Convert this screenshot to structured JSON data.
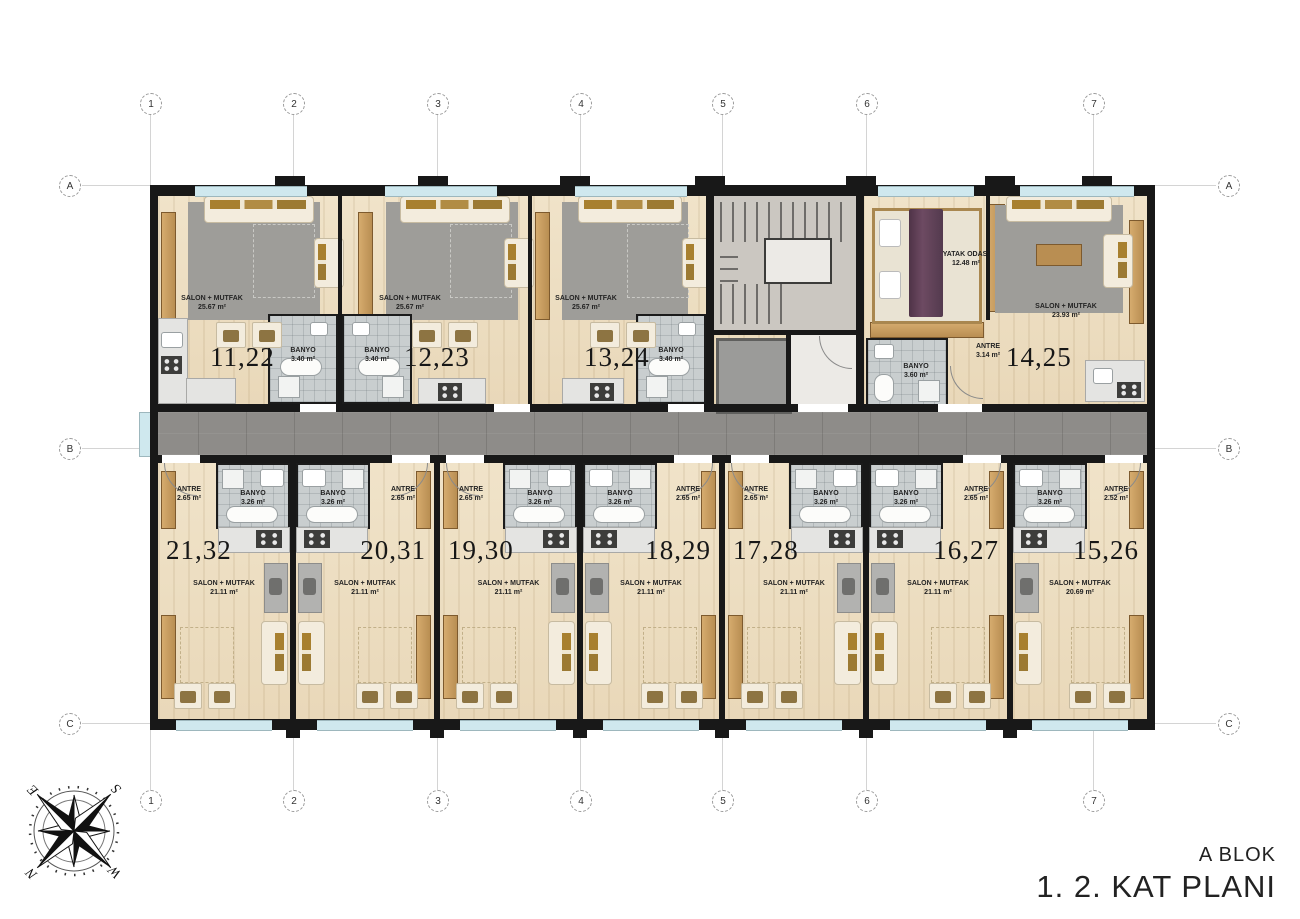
{
  "title": {
    "block": "A BLOK",
    "floor_plan": "1. 2. KAT PLANI"
  },
  "grid": {
    "columns": [
      "1",
      "2",
      "3",
      "4",
      "5",
      "6",
      "7"
    ],
    "rows": [
      "A",
      "B",
      "C"
    ]
  },
  "compass": {
    "north": "N",
    "east": "E",
    "south": "S",
    "west": "W"
  },
  "units": {
    "top": [
      {
        "number": "11,22",
        "salon_label": "SALON + MUTFAK",
        "salon_area": "25.67 m²",
        "banyo_label": "BANYO",
        "banyo_area": "3.40 m²"
      },
      {
        "number": "12,23",
        "salon_label": "SALON + MUTFAK",
        "salon_area": "25.67 m²",
        "banyo_label": "BANYO",
        "banyo_area": "3.40 m²"
      },
      {
        "number": "13,24",
        "salon_label": "SALON + MUTFAK",
        "salon_area": "25.67 m²",
        "banyo_label": "BANYO",
        "banyo_area": "3.40 m²"
      },
      {
        "number": "14,25",
        "salon_label": "SALON + MUTFAK",
        "salon_area": "23.93 m²",
        "banyo_label": "BANYO",
        "banyo_area": "3.60 m²",
        "antre_label": "ANTRE",
        "antre_area": "3.14 m²",
        "bedroom_label": "YATAK ODASI",
        "bedroom_area": "12.48 m²"
      }
    ],
    "bottom": [
      {
        "number": "21,32",
        "antre_label": "ANTRE",
        "antre_area": "2.65 m²",
        "banyo_label": "BANYO",
        "banyo_area": "3.26 m²",
        "salon_label": "SALON + MUTFAK",
        "salon_area": "21.11 m²"
      },
      {
        "number": "20,31",
        "antre_label": "ANTRE",
        "antre_area": "2.65 m²",
        "banyo_label": "BANYO",
        "banyo_area": "3.26 m²",
        "salon_label": "SALON + MUTFAK",
        "salon_area": "21.11 m²"
      },
      {
        "number": "19,30",
        "antre_label": "ANTRE",
        "antre_area": "2.65 m²",
        "banyo_label": "BANYO",
        "banyo_area": "3.26 m²",
        "salon_label": "SALON + MUTFAK",
        "salon_area": "21.11 m²"
      },
      {
        "number": "18,29",
        "antre_label": "ANTRE",
        "antre_area": "2.65 m²",
        "banyo_label": "BANYO",
        "banyo_area": "3.26 m²",
        "salon_label": "SALON + MUTFAK",
        "salon_area": "21.11 m²"
      },
      {
        "number": "17,28",
        "antre_label": "ANTRE",
        "antre_area": "2.65 m²",
        "banyo_label": "BANYO",
        "banyo_area": "3.26 m²",
        "salon_label": "SALON + MUTFAK",
        "salon_area": "21.11 m²"
      },
      {
        "number": "16,27",
        "antre_label": "ANTRE",
        "antre_area": "2.65 m²",
        "banyo_label": "BANYO",
        "banyo_area": "3.26 m²",
        "salon_label": "SALON + MUTFAK",
        "salon_area": "21.11 m²"
      },
      {
        "number": "15,26",
        "antre_label": "ANTRE",
        "antre_area": "2.52 m²",
        "banyo_label": "BANYO",
        "banyo_area": "3.26 m²",
        "salon_label": "SALON + MUTFAK",
        "salon_area": "20.69 m²"
      }
    ]
  }
}
